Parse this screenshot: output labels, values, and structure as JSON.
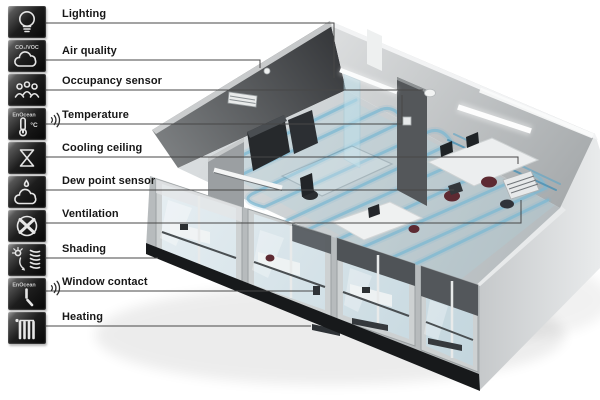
{
  "legend": {
    "items": [
      {
        "label": "Lighting",
        "icon": "light-bulb-icon"
      },
      {
        "label": "Air quality",
        "icon": "cloud-icon",
        "icon_text": "CO₂/VOC"
      },
      {
        "label": "Occupancy sensor",
        "icon": "people-group-icon"
      },
      {
        "label": "Temperature",
        "icon": "thermometer-icon",
        "icon_text": "EnOcean",
        "wireless": true
      },
      {
        "label": "Cooling ceiling",
        "icon": "valve-hourglass-icon"
      },
      {
        "label": "Dew point sensor",
        "icon": "cloud-droplet-icon"
      },
      {
        "label": "Ventilation",
        "icon": "fan-icon"
      },
      {
        "label": "Shading",
        "icon": "sun-blinds-icon"
      },
      {
        "label": "Window contact",
        "icon": "window-handle-icon",
        "icon_text": "EnOcean",
        "wireless": true
      },
      {
        "label": "Heating",
        "icon": "radiator-icon"
      }
    ]
  },
  "scene": {
    "type": "isometric office room cutaway render",
    "colors": {
      "background": "#ffffff",
      "wall_dark": "#4a4c4f",
      "wall_light": "#c7cacc",
      "wall_outer": "#dcdedf",
      "floor": "#c9ced1",
      "cooling_coil": "#7db8d2",
      "coil_header": "#4e92b4",
      "glass": "#dde9ee",
      "shade_panel": "#53575b",
      "plinth": "#17191b",
      "chair_accent": "#5d2a32",
      "leader_line": "#474747",
      "icon_tile": "#0a0a0a",
      "icon_glyph": "#e6e6e6"
    }
  }
}
